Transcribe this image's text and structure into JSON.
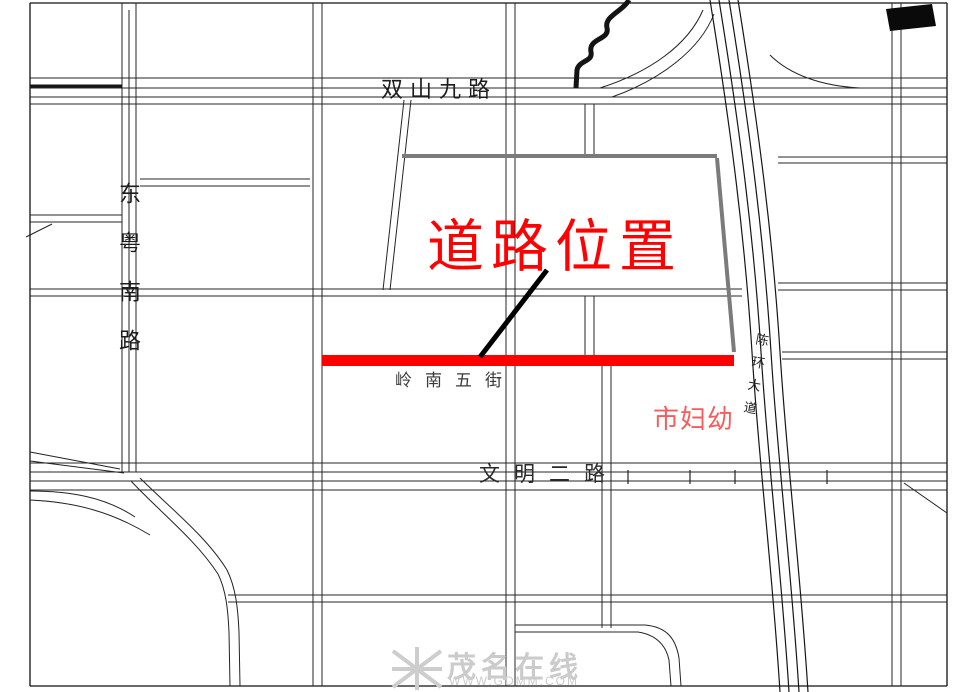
{
  "map": {
    "roads": {
      "top": "双山九路",
      "left": "东粤南路",
      "middle": "岭南五街",
      "bottom": "文明二路",
      "avenue": "陈环大道"
    },
    "annotations": {
      "road_location_title": "道路位置",
      "hospital": "市妇幼"
    },
    "colors": {
      "highlight_red": "#FE0000",
      "title_red": "#FD0202",
      "hospital_red": "#F95B5B",
      "line_black": "#222222",
      "parcel_gray": "#7B7B7B",
      "watermark_gray": "#CBCBCB"
    }
  },
  "watermark": {
    "site_name": "茂名在线",
    "site_url": "WWW.GDMM.COM"
  }
}
